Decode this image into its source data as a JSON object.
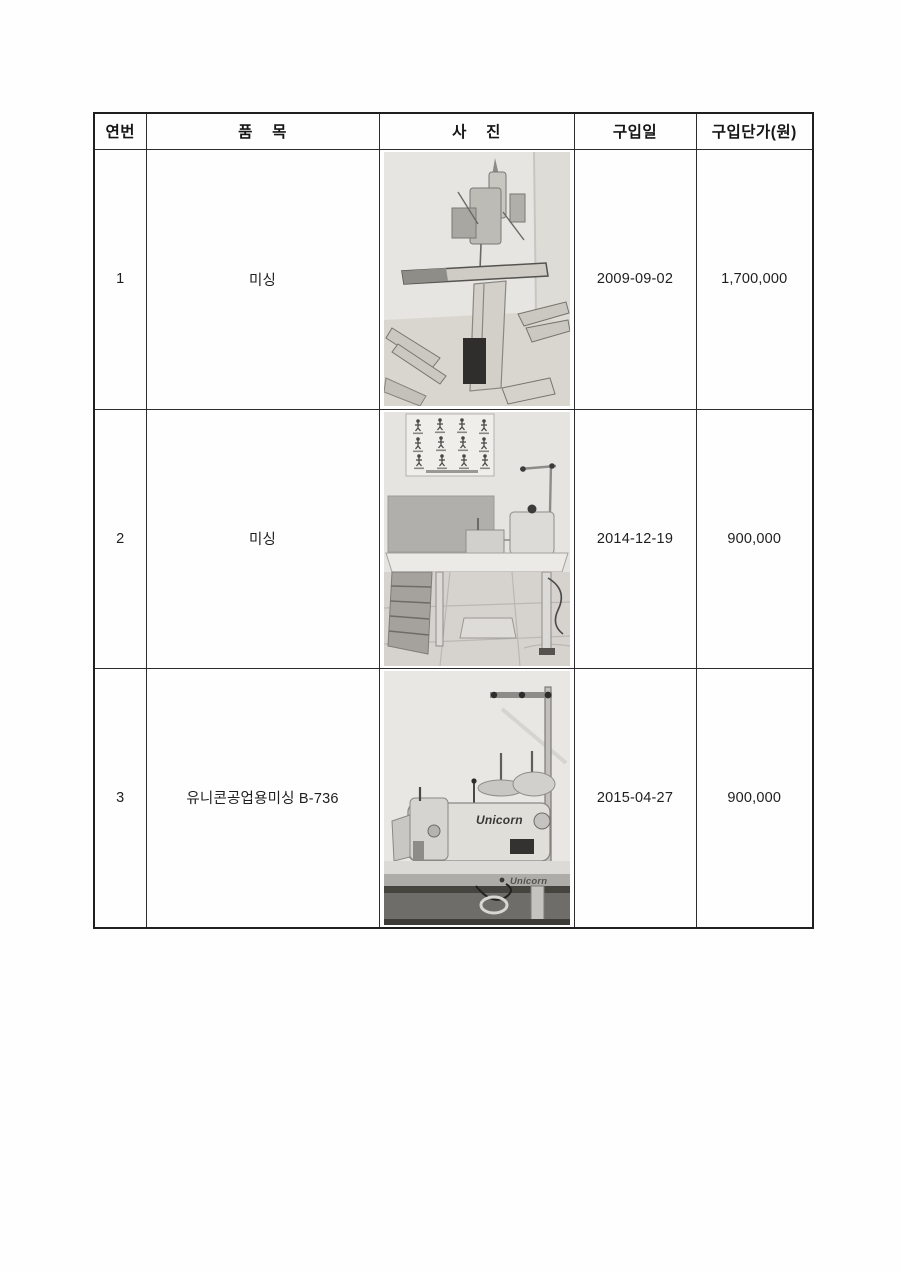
{
  "document": {
    "table": {
      "headers": [
        {
          "label": "연번"
        },
        {
          "label": "품    목"
        },
        {
          "label": "사    진"
        },
        {
          "label": "구입일"
        },
        {
          "label": "구입단가(원)"
        }
      ],
      "rows": [
        {
          "no": "1",
          "item": "미싱",
          "photo": {
            "desc": "industrial sewing machine on pedestal stand in room corner, parts lying on floor"
          },
          "purchase_date": "2009-09-02",
          "unit_price": "1,700,000"
        },
        {
          "no": "2",
          "item": "미싱",
          "photo": {
            "desc": "sewing machine on work table with exercise poster and grey board on wall, drawers and tiled floor"
          },
          "purchase_date": "2014-12-19",
          "unit_price": "900,000"
        },
        {
          "no": "3",
          "item": "유니콘공업용미싱 B-736",
          "photo": {
            "desc": "close-up of Unicorn industrial sewing machine head with thread stand",
            "brand": "Unicorn"
          },
          "purchase_date": "2015-04-27",
          "unit_price": "900,000"
        }
      ]
    }
  }
}
